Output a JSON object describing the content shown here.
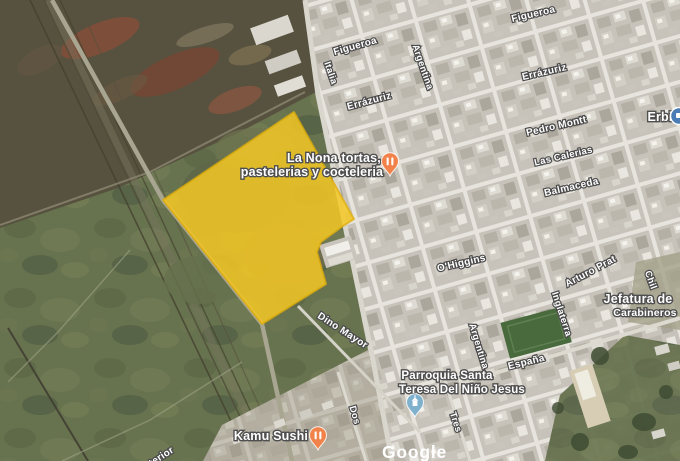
{
  "app": {
    "type": "satellite-map-view",
    "logo": {
      "text": "Google",
      "x": 382,
      "y": 458
    }
  },
  "colors": {
    "overlay_fill": "#F5C824",
    "overlay_stroke": "#DFAE0C",
    "restaurant_pin": "#F1824A",
    "church_pin": "#7FB0CC",
    "store_pin": "#4A7CB5",
    "label_outline": "#4A4A4A"
  },
  "overlay": {
    "name": "highlighted-parcel",
    "fill_opacity": 0.85,
    "points": [
      [
        294,
        112
      ],
      [
        354,
        219
      ],
      [
        343,
        226
      ],
      [
        321,
        242
      ],
      [
        317,
        252
      ],
      [
        326,
        284
      ],
      [
        262,
        324
      ],
      [
        163,
        200
      ]
    ]
  },
  "street_labels": [
    {
      "text": "Figueroa",
      "x": 356,
      "y": 49,
      "rot": -16,
      "size": 10
    },
    {
      "text": "Figueroa",
      "x": 534,
      "y": 17,
      "rot": -13,
      "size": 10
    },
    {
      "text": "Italia",
      "x": 328,
      "y": 74,
      "rot": 71,
      "size": 9.5
    },
    {
      "text": "Argentina",
      "x": 420,
      "y": 68,
      "rot": 71,
      "size": 9.5
    },
    {
      "text": "Errázuriz",
      "x": 370,
      "y": 104,
      "rot": -15,
      "size": 10
    },
    {
      "text": "Errázuriz",
      "x": 545,
      "y": 75,
      "rot": -13,
      "size": 10
    },
    {
      "text": "Pedro Montt",
      "x": 557,
      "y": 129,
      "rot": -13,
      "size": 10
    },
    {
      "text": "Las Calerias",
      "x": 564,
      "y": 159,
      "rot": -13,
      "size": 9.5
    },
    {
      "text": "Balmaceda",
      "x": 572,
      "y": 190,
      "rot": -13,
      "size": 10
    },
    {
      "text": "O'Higgins",
      "x": 462,
      "y": 266,
      "rot": -13,
      "size": 10
    },
    {
      "text": "Arturo Prat",
      "x": 592,
      "y": 274,
      "rot": -28,
      "size": 10
    },
    {
      "text": "Inglaterra",
      "x": 559,
      "y": 315,
      "rot": 72,
      "size": 9.5
    },
    {
      "text": "Argentina",
      "x": 476,
      "y": 347,
      "rot": 73,
      "size": 9.5
    },
    {
      "text": "Chil",
      "x": 648,
      "y": 281,
      "rot": 70,
      "size": 9.5
    },
    {
      "text": "España",
      "x": 527,
      "y": 365,
      "rot": -14,
      "size": 10
    },
    {
      "text": "Tres",
      "x": 453,
      "y": 423,
      "rot": 72,
      "size": 9.5
    },
    {
      "text": "Dos",
      "x": 352,
      "y": 416,
      "rot": 74,
      "size": 9.5
    },
    {
      "text": "Dino Mayor",
      "x": 341,
      "y": 333,
      "rot": 33,
      "size": 10
    },
    {
      "text": "terior",
      "x": 163,
      "y": 459,
      "rot": -33,
      "size": 10
    }
  ],
  "poi_labels": [
    {
      "name": "la-nona-restaurant",
      "lines": [
        {
          "text": "La Nona tortas,",
          "x": 334,
          "y": 162,
          "size": 12.5
        },
        {
          "text": "pastelerias y cocteleria",
          "x": 312,
          "y": 176,
          "size": 12.5
        }
      ]
    },
    {
      "name": "kamu-sushi-restaurant",
      "lines": [
        {
          "text": "Kamu Sushi",
          "x": 271,
          "y": 440,
          "size": 12.5
        }
      ]
    },
    {
      "name": "parroquia-santa-teresa",
      "lines": [
        {
          "text": "Parroquia Santa",
          "x": 447,
          "y": 379,
          "size": 11.5
        },
        {
          "text": "Teresa Del Niño Jesus",
          "x": 462,
          "y": 393,
          "size": 11.5
        }
      ]
    },
    {
      "name": "jefatura-carabineros",
      "lines": [
        {
          "text": "Jefatura de",
          "x": 638,
          "y": 303,
          "size": 12.5
        },
        {
          "text": "Carabineros",
          "x": 645,
          "y": 316,
          "size": 10.5
        }
      ]
    },
    {
      "name": "erbi-store",
      "lines": [
        {
          "text": "Erbi",
          "x": 660,
          "y": 121,
          "size": 12.5
        }
      ]
    }
  ],
  "pins": [
    {
      "name": "restaurant-pin-la-nona",
      "x": 390,
      "y": 176,
      "color_key": "restaurant_pin",
      "glyph": "utensils"
    },
    {
      "name": "restaurant-pin-kamu-sushi",
      "x": 318,
      "y": 450,
      "color_key": "restaurant_pin",
      "glyph": "utensils"
    },
    {
      "name": "church-pin-parroquia",
      "x": 415,
      "y": 417,
      "color_key": "church_pin",
      "glyph": "church"
    },
    {
      "name": "store-icon-erbi",
      "x": 679,
      "y": 116,
      "color_key": "store_pin",
      "glyph": "circle"
    }
  ]
}
